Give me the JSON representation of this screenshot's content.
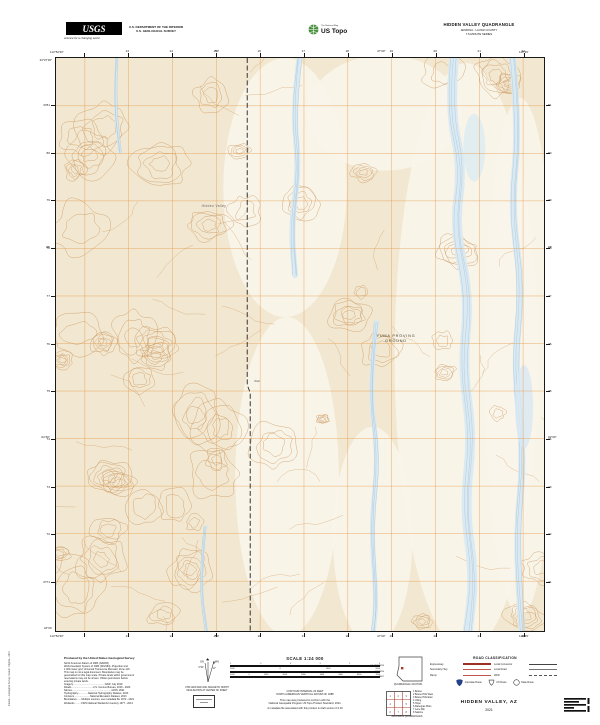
{
  "colors": {
    "terrain": "#f2e7d0",
    "terrain_light": "#faf5ea",
    "contour": "#c8935a",
    "grid": "#e39a4b",
    "water_fill": "#d9e9f2",
    "water_line": "#a4c4d8",
    "road_red": "#b03a2e",
    "ustopo_green": "#4a8f3f"
  },
  "header": {
    "usgs_logo_text": "USGS",
    "usgs_tagline": "science for a changing world",
    "dept_line1": "U.S. DEPARTMENT OF THE INTERIOR",
    "dept_line2": "U.S. GEOLOGICAL SURVEY",
    "ustopo_brand": "The National Map",
    "ustopo_name": "US Topo",
    "title_line1": "HIDDEN VALLEY QUADRANGLE",
    "title_line2": "ARIZONA - LA PAZ COUNTY",
    "title_line3": "7.5-MINUTE SERIES"
  },
  "map": {
    "corners": {
      "nw_lat": "34°07'30\"",
      "nw_lon": "113°52'30\"",
      "ne_lon": "113°45'",
      "sw_lat": "34°00'",
      "sw_lon": "113°52'30\"",
      "se_lon": "113°45'"
    },
    "top_minutes": [
      "50'",
      "47'30\""
    ],
    "side_minutes": [
      "05'",
      "02'30\""
    ],
    "top_grid": [
      "13",
      "14",
      "15",
      "16",
      "17",
      "18",
      "19",
      "20",
      "21",
      "22"
    ],
    "bottom_grid": [
      "13",
      "14",
      "15",
      "16",
      "17",
      "18",
      "19",
      "20",
      "21",
      "22"
    ],
    "left_grid": [
      "3781",
      "80",
      "79",
      "78",
      "77",
      "76",
      "75",
      "74",
      "73",
      "72",
      "3771"
    ],
    "right_grid": [
      "81",
      "80",
      "79",
      "78",
      "77",
      "76",
      "75",
      "74",
      "73",
      "72",
      "71"
    ],
    "labels": {
      "area_line1": "YUMA PROVING",
      "area_line2": "GROUND",
      "feature": "Hidden Valley",
      "well": "Well"
    }
  },
  "footer": {
    "credits_title": "Produced by the United States Geological Survey",
    "credits_lines": [
      "North American Datum of 1983 (NAD83)",
      "World Geodetic System of 1984 (WGS84). Projection and",
      "1 000-meter grid: Universal Transverse Mercator, Zone 11S",
      "This map is not a legal document. Boundaries may be",
      "generalized for this map scale. Private lands within government",
      "reservations may not be shown. Obtain permission before",
      "entering private lands.",
      "Imagery..............................................NAIP, July 2019",
      "Roads...............................U.S. Census Bureau, 2016 - 2020",
      "Names.........................................................GNIS, 2021",
      "Hydrography..............National Hydrography Dataset, 2013",
      "Contours.......................National Elevation Dataset, 2013",
      "Boundaries.......Multiple sources; see metadata file 1972 - 2021",
      "Wetlands..........FWS National Wetlands Inventory 1977 - 2014"
    ],
    "declination": {
      "star": "★",
      "gn": "GN",
      "mn": "MN",
      "mn_value": "11°",
      "gn_value": "0°02'",
      "caption1": "UTM GRID AND 2021 MAGNETIC NORTH",
      "caption2": "DECLINATION AT CENTER OF SHEET"
    },
    "scale": {
      "title": "SCALE 1:24 000",
      "bars": [
        {
          "unit": "KILOMETERS",
          "ticks": [
            "1",
            ".5",
            "0",
            "1",
            "2",
            "3"
          ]
        },
        {
          "unit": "METERS",
          "ticks": [
            "1000",
            "0",
            "1000",
            "2000"
          ]
        },
        {
          "unit": "FEET",
          "ticks": [
            "1000",
            "0",
            "1000",
            "2000",
            "3000",
            "4000",
            "5000",
            "6000",
            "7000"
          ]
        }
      ],
      "notes": [
        "CONTOUR INTERVAL 20 FEET",
        "NORTH AMERICAN VERTICAL DATUM OF 1988",
        "This map was produced to conform with the",
        "National Geospatial Program US Topo Product Standard, 2021.",
        "A metadata file associated with this product is draft version 0.6.19"
      ]
    },
    "location_caption": "QUADRANGLE LOCATION",
    "adjoining_caption": "ADJOINING QUADRANGLES",
    "adjoining_quads": [
      "Bouse",
      "Bouse Hills West",
      "Bouse Hills East",
      "Utting",
      "Hope",
      "Ranegras Plain",
      "Lone Mtn",
      "Salome"
    ],
    "roads": {
      "title": "ROAD CLASSIFICATION",
      "rows": [
        {
          "l": "Expressway",
          "ls": "expressway",
          "r": "Local Connector",
          "rs": "connector"
        },
        {
          "l": "Secondary Hwy",
          "ls": "secondary",
          "r": "Local Road",
          "rs": "local"
        },
        {
          "l": "Ramp",
          "ls": "ramp",
          "r": "4WD",
          "rs": "fourwd"
        }
      ],
      "shields": [
        {
          "type": "interstate",
          "label": "Interstate Route"
        },
        {
          "type": "us",
          "label": "US Route"
        },
        {
          "type": "state",
          "label": "State Route"
        }
      ]
    },
    "map_name": "HIDDEN VALLEY,  AZ",
    "year": "2021",
    "imprint": "Interior—Geological Survey, Reston, Virginia—2021"
  }
}
